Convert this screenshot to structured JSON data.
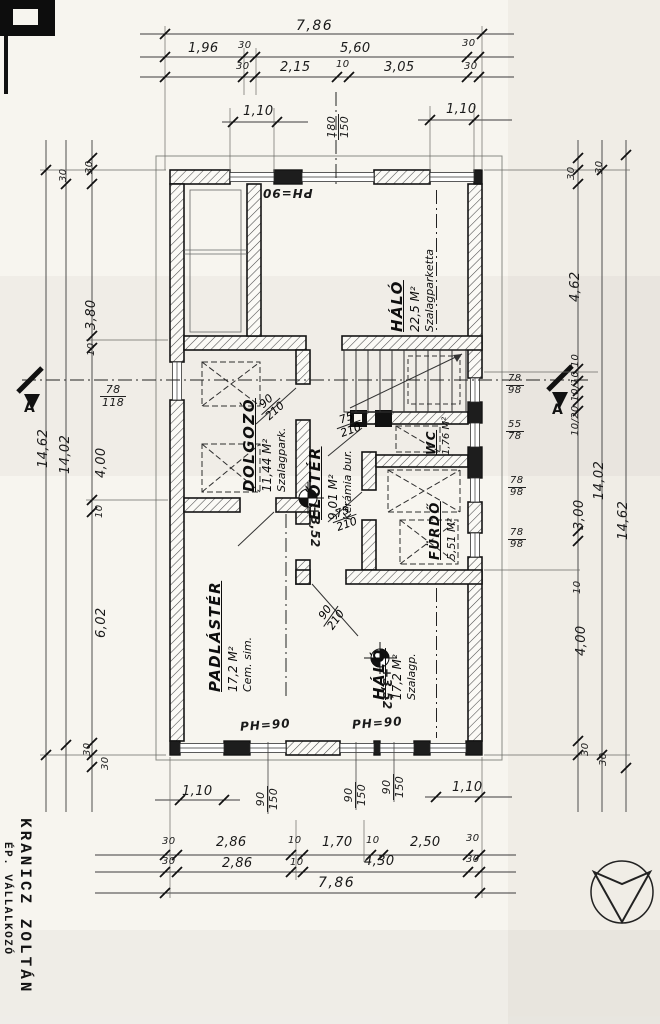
{
  "stamp": {
    "line1": "KRANICZ ZOLTÁN",
    "line2": "ÉP. VÁLLALKOZÓ"
  },
  "section": {
    "left": "A",
    "right": "A"
  },
  "rooms": {
    "halo_top": {
      "name": "HÁLÓ",
      "area": "22,5 M²",
      "floor": "Szalagparketta"
    },
    "eloter": {
      "name": "ELŐTÉR",
      "area": "9,01 M²",
      "floor": "Kerámia bur."
    },
    "dolgozo": {
      "name": "DOLGOZÓ",
      "area": "11,44 M²",
      "floor": "Szalagpark."
    },
    "wc": {
      "name": "WC",
      "area": "1,76 M²"
    },
    "furdo": {
      "name": "FÜRDŐ",
      "area": "5,51 M²"
    },
    "padlaster": {
      "name": "PADLÁSTÉR",
      "area": "17,2 M²",
      "floor": "Cem. sim."
    },
    "halo_bottom": {
      "name": "HÁLÓ",
      "area": "17,2 M²",
      "floor": "Szalagp."
    }
  },
  "levels": {
    "eloter": "+3,52",
    "halo": "+3,52"
  },
  "parapet": {
    "top": "PH=90",
    "bottom_left": "PH=90",
    "bottom_right": "PH=90"
  },
  "doors": {
    "dolgozo": {
      "w": "90",
      "h": "210"
    },
    "wc": {
      "w": "75",
      "h": "210"
    },
    "furdo": {
      "w": "75",
      "h": "210"
    },
    "halo_bottom": {
      "w": "90",
      "h": "210"
    }
  },
  "windows": {
    "top_main": {
      "w": "180",
      "h": "150"
    },
    "left_main": {
      "w": "78",
      "h": "118"
    },
    "right_1": {
      "w": "78",
      "h": "98"
    },
    "right_2": {
      "w": "55",
      "h": "78"
    },
    "right_3": {
      "w": "78",
      "h": "98"
    },
    "right_4": {
      "w": "78",
      "h": "98"
    },
    "bottom_1": {
      "w": "90",
      "h": "150"
    },
    "bottom_2": {
      "w": "90",
      "h": "150"
    },
    "bottom_3": {
      "w": "90",
      "h": "150"
    }
  },
  "dims": {
    "top": {
      "total": "7,86",
      "row2": [
        "1,96",
        "30",
        "5,60",
        "30"
      ],
      "row3": [
        "30",
        "2,15",
        "10",
        "3,05",
        "30"
      ],
      "win_left": "1,10",
      "win_right": "1,10"
    },
    "bottom": {
      "total": "7,86",
      "row1": [
        "30",
        "2,86",
        "10",
        "1,70",
        "10",
        "2,50",
        "30"
      ],
      "row2": [
        "30",
        "2,86",
        "10",
        "4,30",
        "30"
      ],
      "win_left": "1,10",
      "win_right": "1,10"
    },
    "left": {
      "overall": "14,62",
      "interior": "14,02",
      "chain": [
        "30",
        "30",
        "3,80",
        "10",
        "4,00",
        "10",
        "6,02",
        "30",
        "30"
      ]
    },
    "right": {
      "overall": "14,62",
      "interior": "14,02",
      "chain": [
        "30",
        "30",
        "4,62",
        "10/20 10/10 10",
        "3,00",
        "10",
        "4,00",
        "30",
        "30"
      ]
    }
  }
}
